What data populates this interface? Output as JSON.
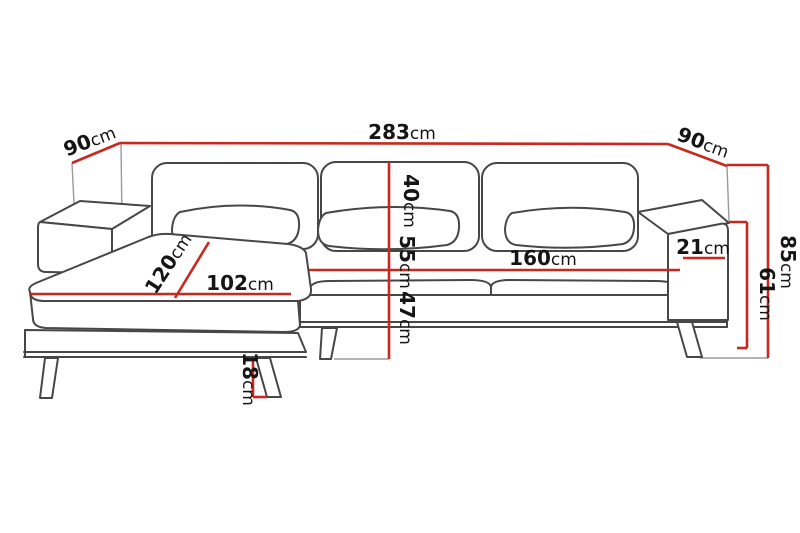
{
  "diagram": {
    "name": "corner-sofa-dimension-diagram",
    "unit": "cm",
    "colors": {
      "dimension_line": "#c8281e",
      "outline": "#474747",
      "construction_line": "#9a9a9a",
      "text": "#151515",
      "background": "#ffffff"
    },
    "dims": {
      "width_total": {
        "value": "283",
        "unit": "cm"
      },
      "depth_left": {
        "value": "90",
        "unit": "cm"
      },
      "depth_right": {
        "value": "90",
        "unit": "cm"
      },
      "height_total": {
        "value": "85",
        "unit": "cm"
      },
      "height_arm": {
        "value": "61",
        "unit": "cm"
      },
      "arm_width": {
        "value": "21",
        "unit": "cm"
      },
      "seat_width": {
        "value": "160",
        "unit": "cm"
      },
      "chaise_width": {
        "value": "102",
        "unit": "cm"
      },
      "chaise_depth": {
        "value": "120",
        "unit": "cm"
      },
      "back_height": {
        "value": "40",
        "unit": "cm"
      },
      "seat_height": {
        "value": "55",
        "unit": "cm"
      },
      "frame_height": {
        "value": "47",
        "unit": "cm"
      },
      "leg_height": {
        "value": "18",
        "unit": "cm"
      }
    }
  }
}
